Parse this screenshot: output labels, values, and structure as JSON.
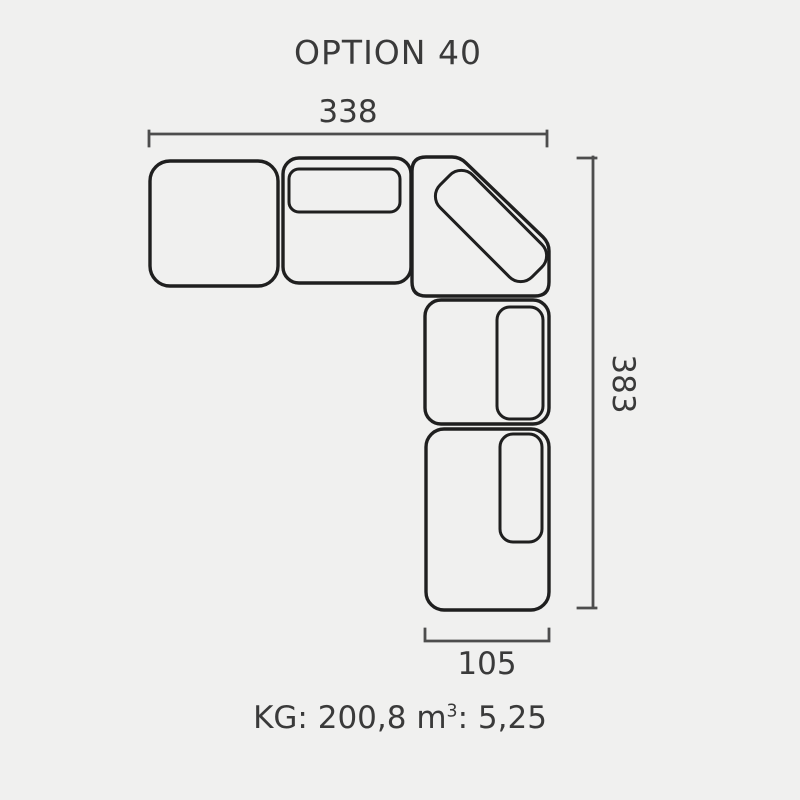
{
  "title": "OPTION 40",
  "colors": {
    "background": "#f0f0ef",
    "outline": "#1f1f1f",
    "dimension_line": "#4d4d4d",
    "text": "#3a3a3a"
  },
  "diagram": {
    "kind": "sofa-sectional-top-view",
    "dimensions": {
      "top_width": "338",
      "right_height": "383",
      "bottom_width": "105"
    }
  },
  "footer": {
    "kg_label": "KG:",
    "kg_value": "200,8",
    "volume_unit_base": "m",
    "volume_unit_exp": "3",
    "volume_colon": ":",
    "volume_value": "5,25"
  }
}
